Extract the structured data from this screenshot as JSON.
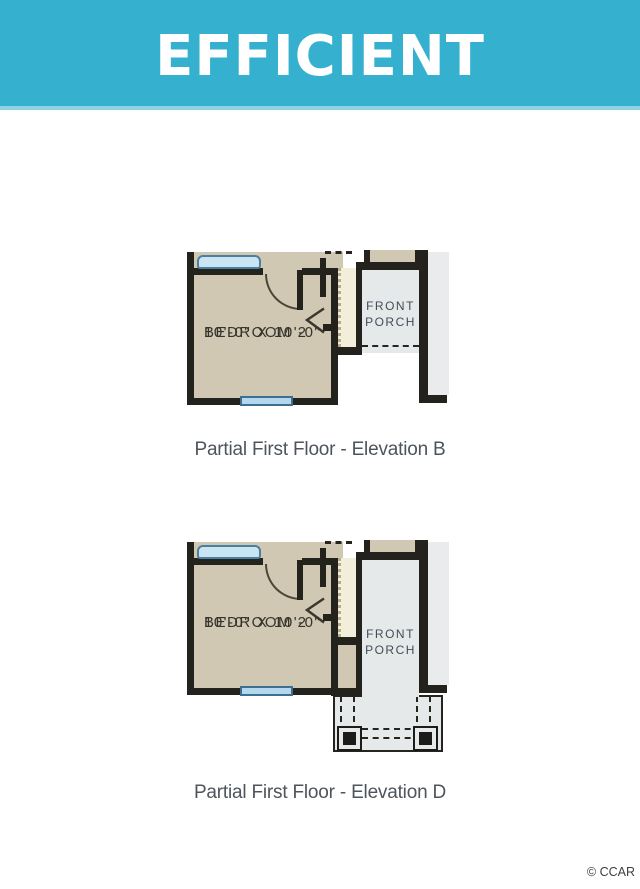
{
  "banner": {
    "title": "EFFICIENT",
    "background_color": "#36b0cf",
    "accent_color": "#8dd3e2",
    "text_color": "#ffffff"
  },
  "plans": [
    {
      "id": "elevation-b",
      "caption": "Partial First Floor - Elevation B",
      "room": {
        "name": "BEDROOM 2",
        "dims": "10'-0\" X 10'-0\""
      },
      "porch_label": "FRONT PORCH"
    },
    {
      "id": "elevation-d",
      "caption": "Partial First Floor - Elevation D",
      "room": {
        "name": "BEDROOM 2",
        "dims": "10'-0\" X 10'-0\""
      },
      "porch_label": "FRONT PORCH"
    }
  ],
  "watermark": "© CCAR",
  "colors": {
    "wall": "#24221d",
    "room_fill": "#d1c8b3",
    "porch_fill": "#e6e9ea",
    "closet_fill": "#f3eeda",
    "window_fill": "#c9e5f4",
    "caption_text": "#4d545b"
  }
}
